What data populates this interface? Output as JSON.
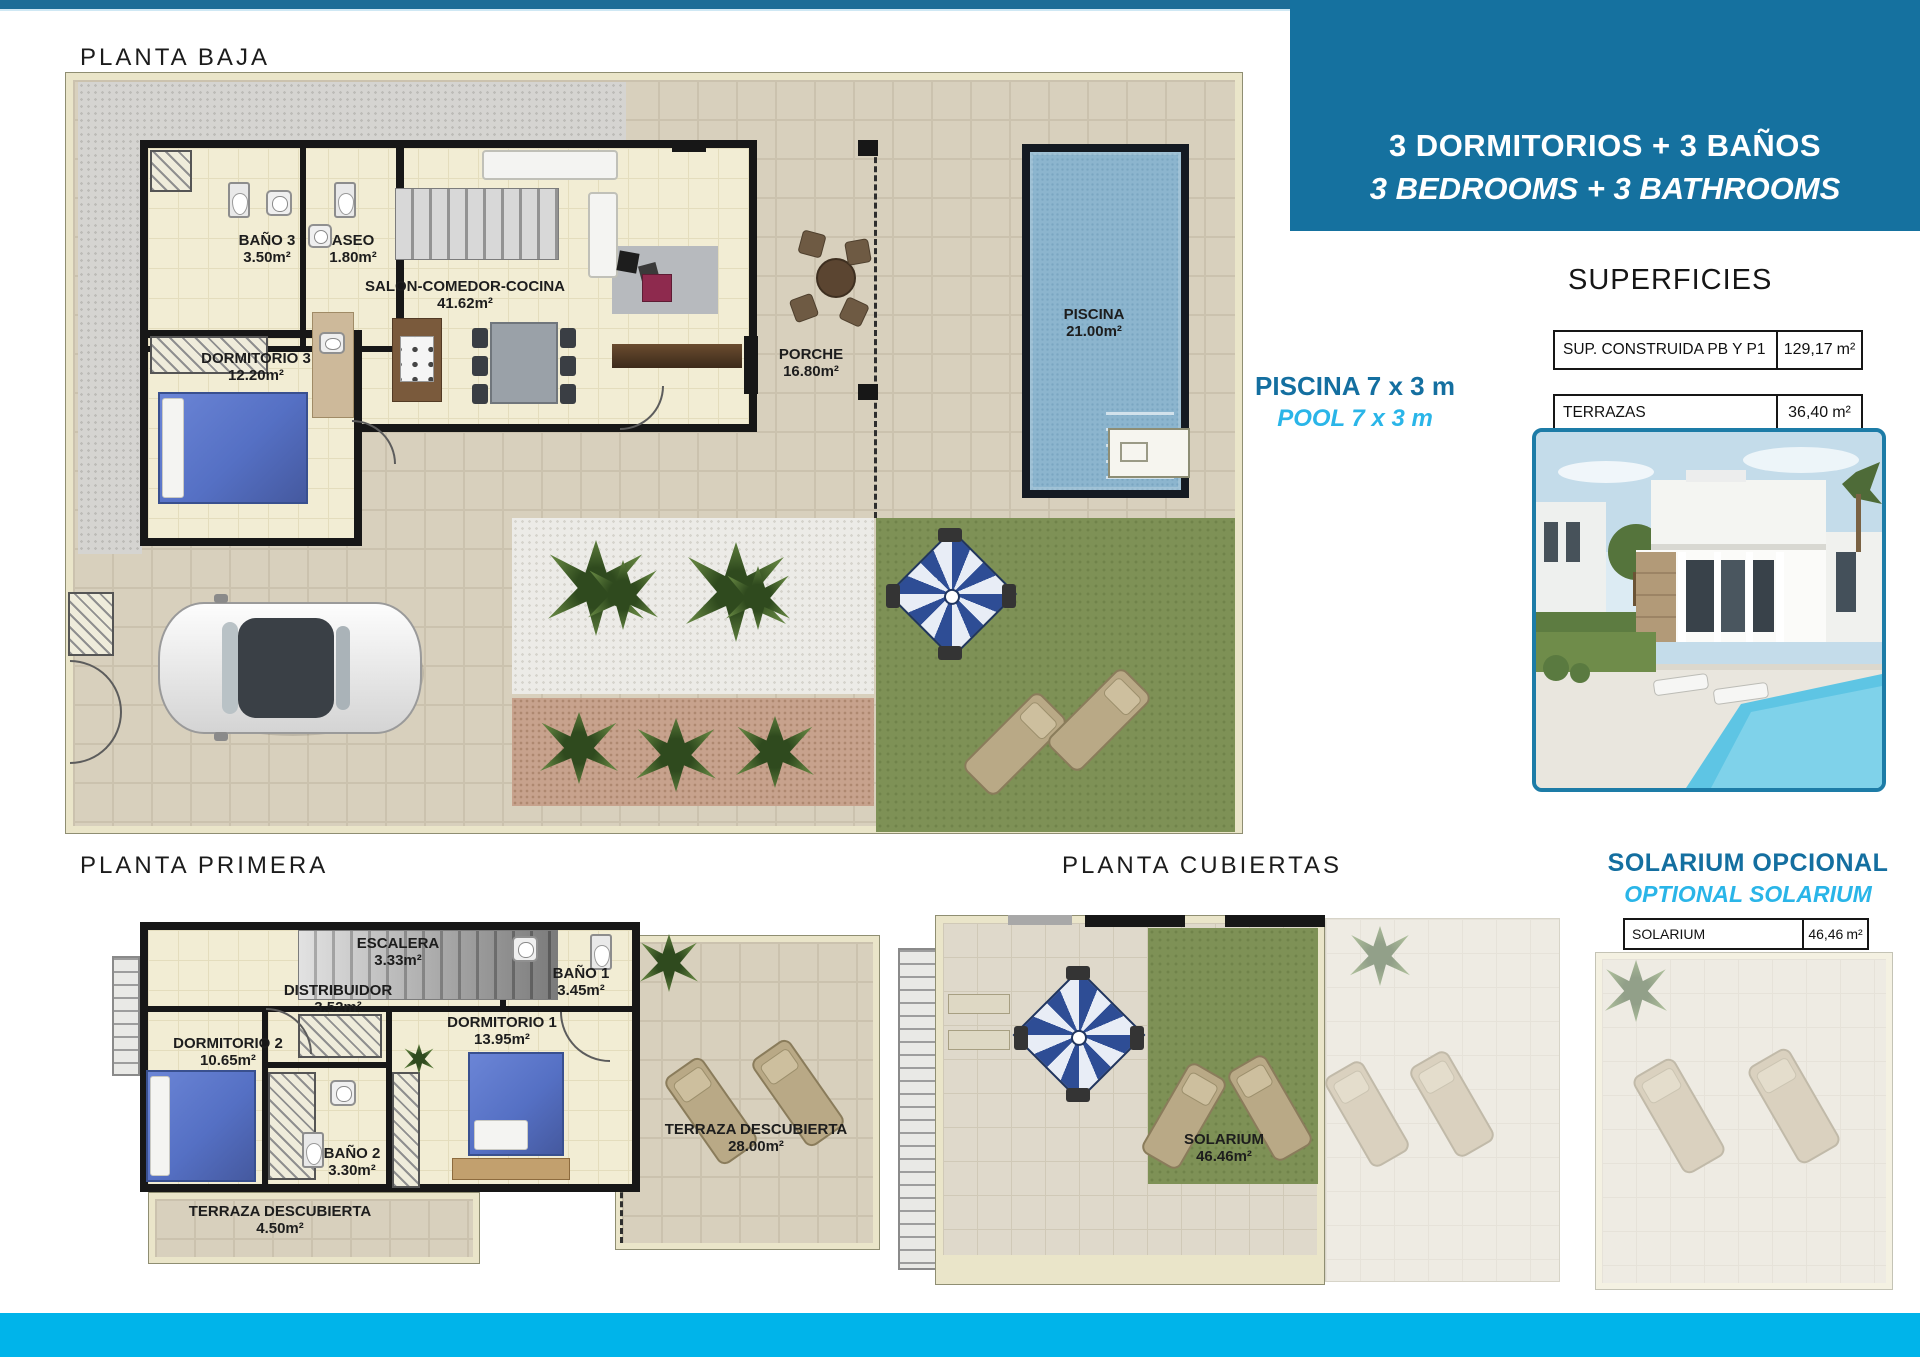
{
  "banner": {
    "line1": "3 DORMITORIOS + 3 BAÑOS",
    "line2": "3 BEDROOMS + 3 BATHROOMS"
  },
  "sections": {
    "ground_floor_title": "PLANTA BAJA",
    "first_floor_title": "PLANTA PRIMERA",
    "roof_title": "PLANTA CUBIERTAS"
  },
  "pool_note": {
    "line1": "PISCINA 7 x 3 m",
    "line2": "POOL 7 x 3 m"
  },
  "solarium_note": {
    "line1": "SOLARIUM OPCIONAL",
    "line2": "OPTIONAL SOLARIUM"
  },
  "superficies": {
    "title": "SUPERFICIES",
    "rows": [
      {
        "label": "SUP. CONSTRUIDA PB Y P1",
        "value": "129,17",
        "unit": "m²"
      },
      {
        "label": "TERRAZAS",
        "value": "36,40",
        "unit": "m²"
      },
      {
        "label": "TOTAL",
        "value": "165,57",
        "unit": "m²"
      }
    ]
  },
  "solarium_table": {
    "label": "SOLARIUM",
    "value": "46,46",
    "unit": "m²"
  },
  "ground_floor": {
    "rooms": [
      {
        "name": "BAÑO 3",
        "area": "3.50m²"
      },
      {
        "name": "ASEO",
        "area": "1.80m²"
      },
      {
        "name": "SALON-COMEDOR-COCINA",
        "area": "41.62m²"
      },
      {
        "name": "DORMITORIO 3",
        "area": "12.20m²"
      },
      {
        "name": "PORCHE",
        "area": "16.80m²"
      },
      {
        "name": "PISCINA",
        "area": "21.00m²"
      }
    ]
  },
  "first_floor": {
    "rooms": [
      {
        "name": "ESCALERA",
        "area": "3.33m²"
      },
      {
        "name": "DISTRIBUIDOR",
        "area": "3.52m²"
      },
      {
        "name": "BAÑO 1",
        "area": "3.45m²"
      },
      {
        "name": "DORMITORIO 1",
        "area": "13.95m²"
      },
      {
        "name": "DORMITORIO 2",
        "area": "10.65m²"
      },
      {
        "name": "BAÑO 2",
        "area": "3.30m²"
      },
      {
        "name": "TERRAZA DESCUBIERTA",
        "area": "28.00m²"
      },
      {
        "name": "TERRAZA DESCUBIERTA",
        "area": "4.50m²"
      }
    ]
  },
  "roof": {
    "rooms": [
      {
        "name": "SOLARIUM",
        "area": "46.46m²"
      }
    ]
  },
  "colors": {
    "accent_dark_blue": "#15719f",
    "accent_cyan": "#29b5e8",
    "footer_cyan": "#00b4ea"
  }
}
